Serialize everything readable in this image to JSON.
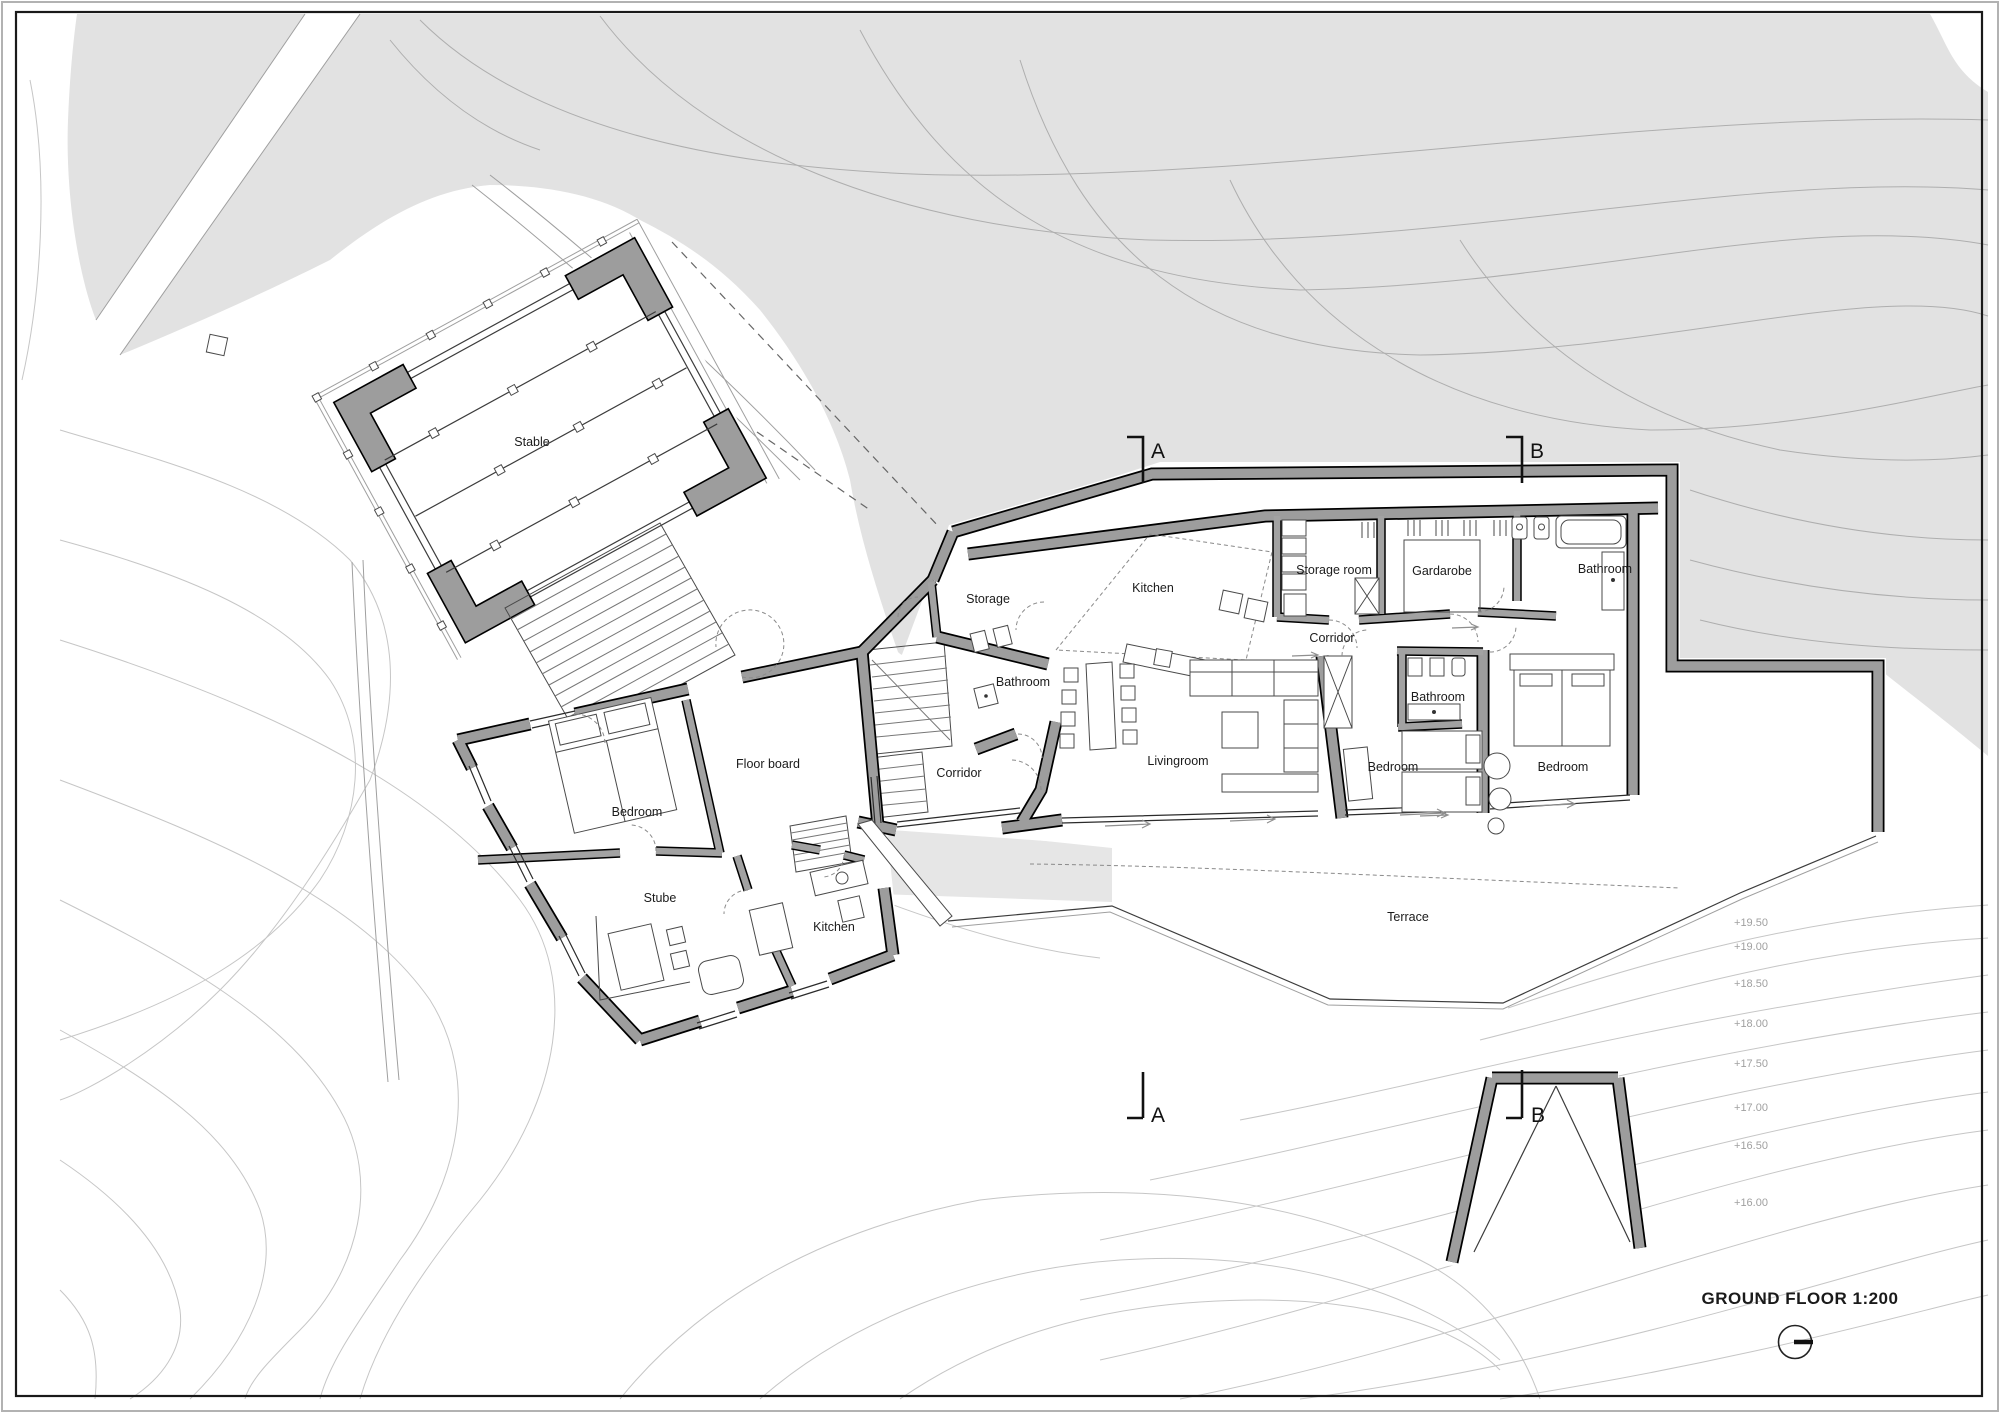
{
  "drawing": {
    "title": "GROUND FLOOR 1:200",
    "scale": "1:200"
  },
  "rooms": {
    "stable": "Stable",
    "old_bedroom": "Bedroom",
    "floor_board": "Floor board",
    "stube": "Stube",
    "old_kitchen": "Kitchen",
    "old_corridor": "Corridor",
    "storage": "Storage",
    "conn_bathroom": "Bathroom",
    "new_kitchen": "Kitchen",
    "storage_room": "Storage room",
    "gardarobe": "Gardarobe",
    "new_corridor": "Corridor",
    "bathroom_top": "Bathroom",
    "bathroom_mid": "Bathroom",
    "livingroom": "Livingroom",
    "bedroom_mid": "Bedroom",
    "bedroom_right": "Bedroom",
    "terrace": "Terrace"
  },
  "sections": {
    "a": "A",
    "b": "B"
  },
  "elevations": [
    "+19.50",
    "+19.00",
    "+18.50",
    "+18.00",
    "+17.50",
    "+17.00",
    "+16.50",
    "+16.00"
  ],
  "colors": {
    "wall_fill": "#9d9d9d",
    "terrain": "#e2e2e2",
    "contour": "#aeaeae",
    "label": "#1b1b1b",
    "elevation_label": "#a0a0a0"
  }
}
